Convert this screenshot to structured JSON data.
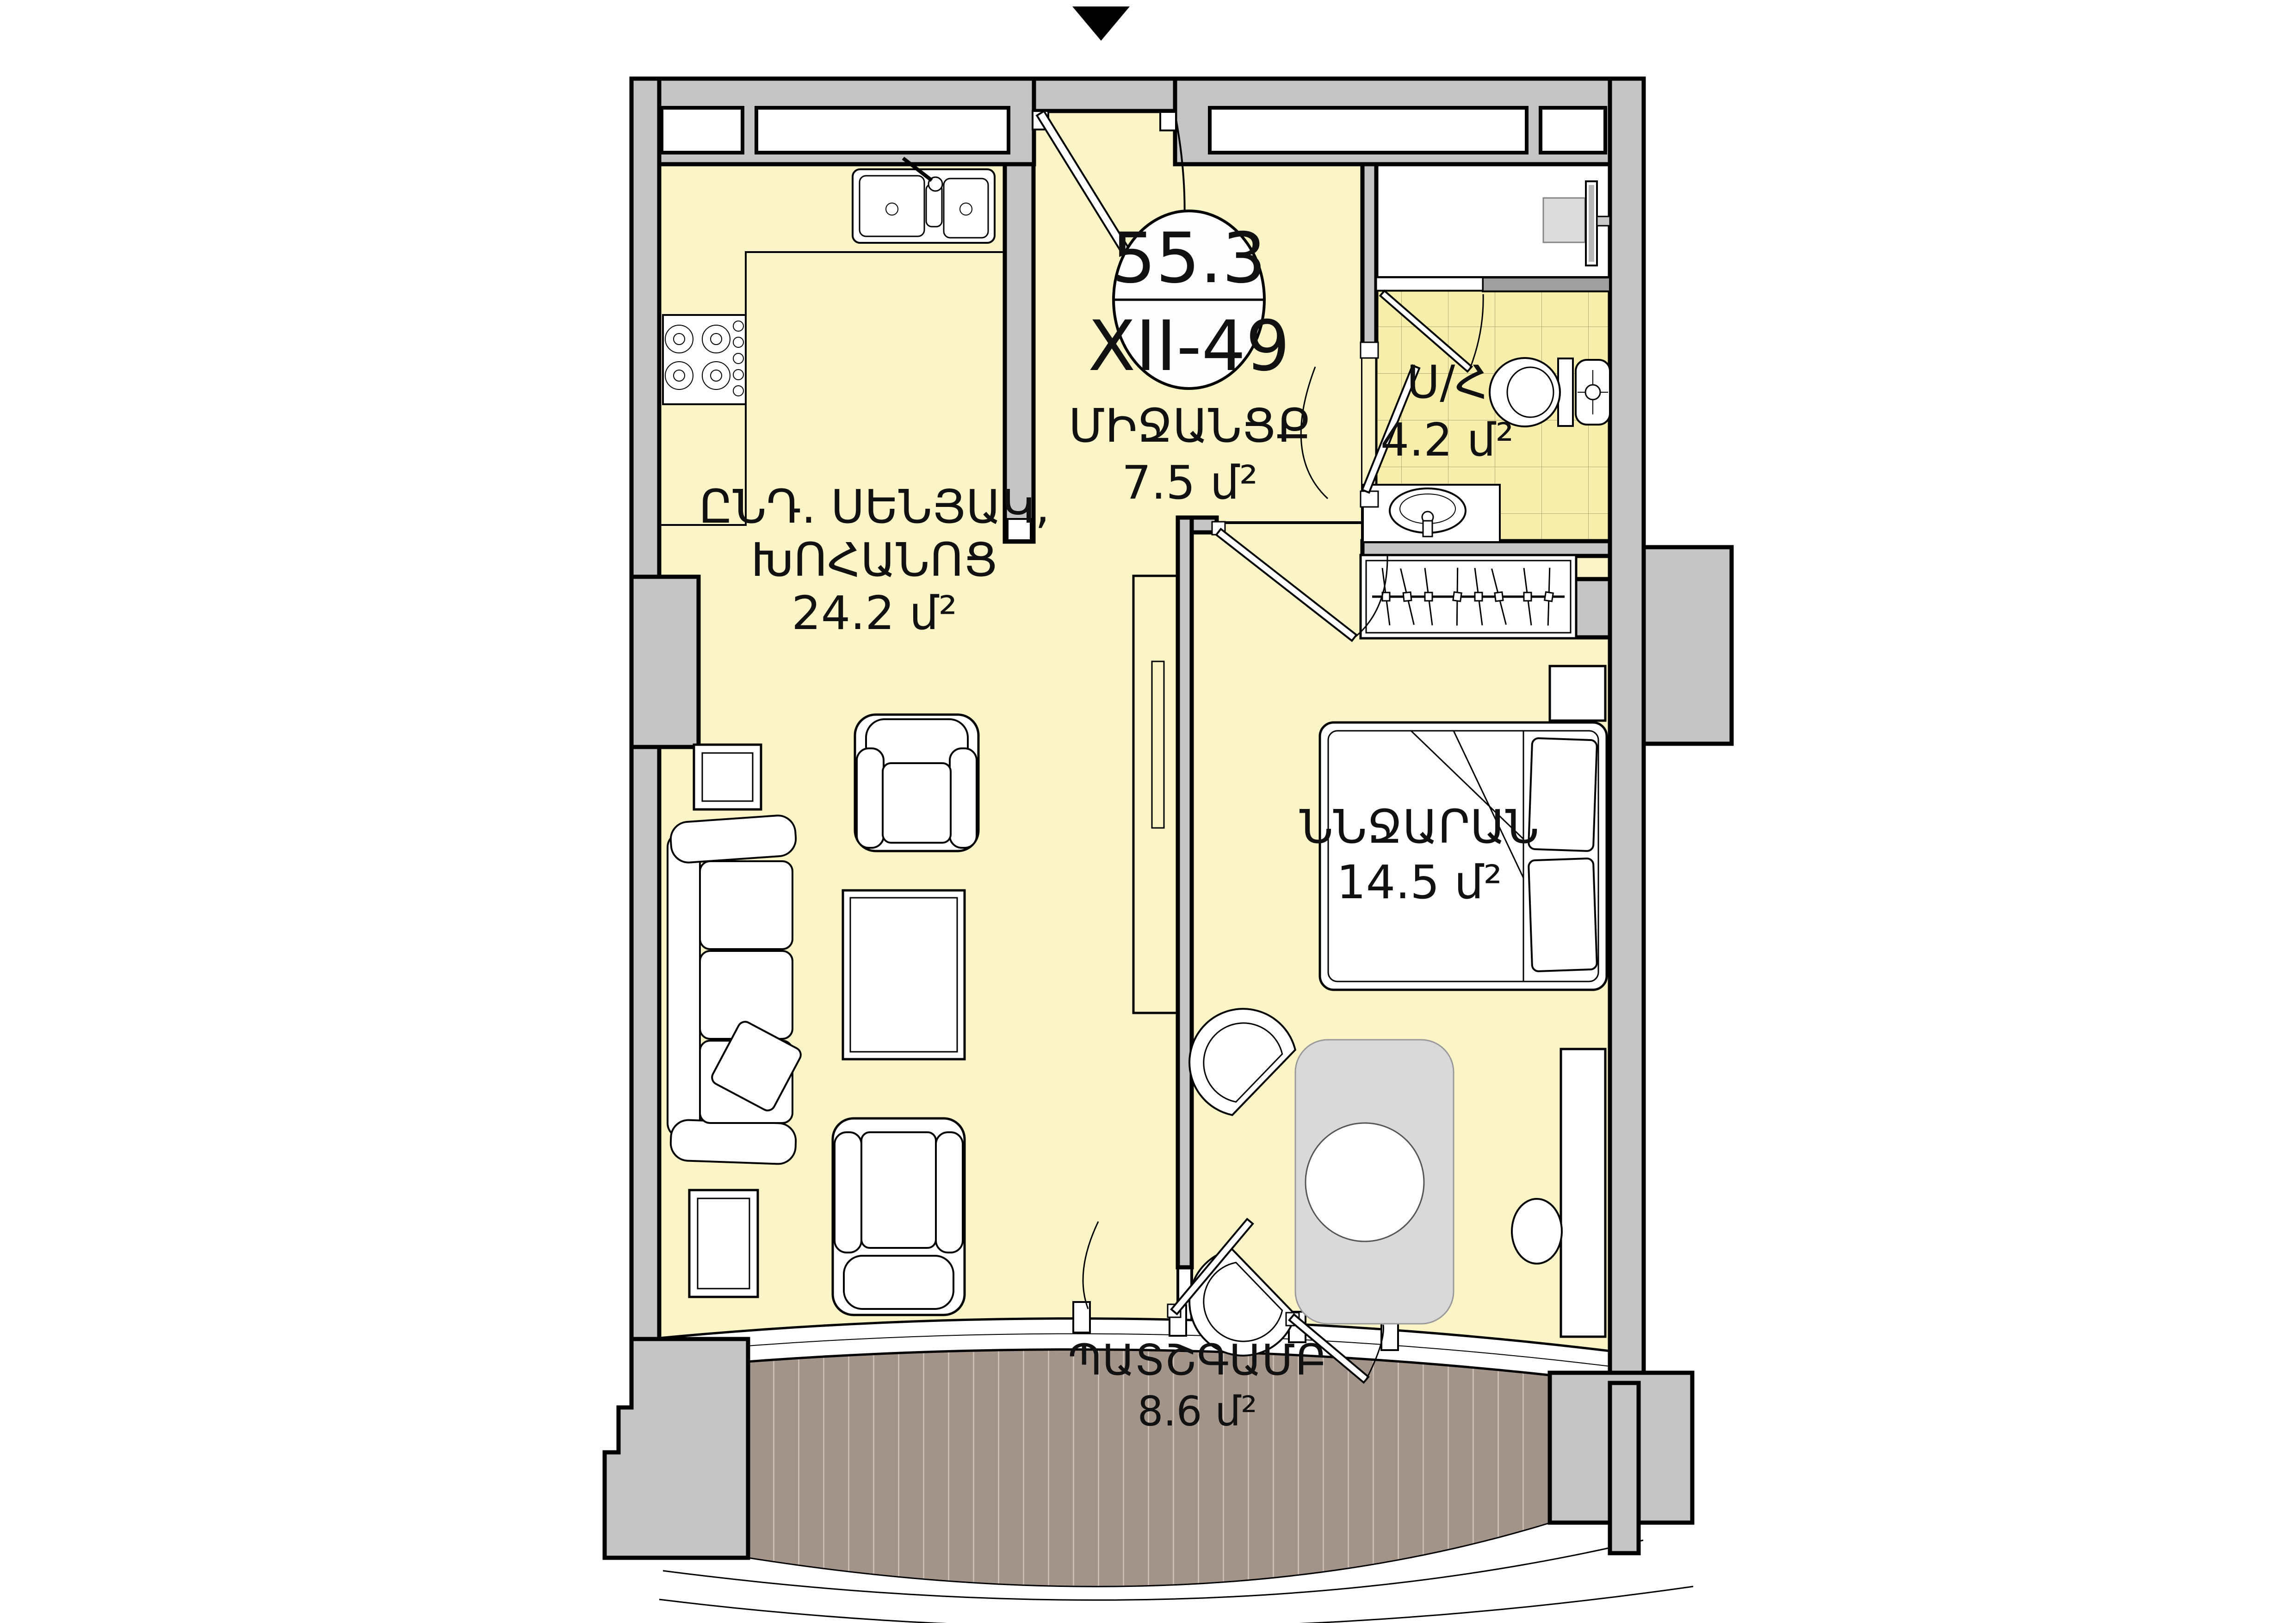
{
  "document": {
    "type": "apartment-floor-plan"
  },
  "icons": {
    "entrance-marker": "down-triangle"
  },
  "unit": {
    "total_area": "55.3",
    "number": "XII-49"
  },
  "rooms": {
    "hallway": {
      "name": "ՄԻՋԱՆՑՔ",
      "area": "7.5 մ²"
    },
    "living_kitchen": {
      "name_line1": "ԸՆԴ. ՍԵՆՅԱԿ,",
      "name_line2": "ԽՈՀԱՆՈՑ",
      "area": "24.2 մ²"
    },
    "bathroom": {
      "name": "Ս/Հ",
      "area": "4.2 մ²"
    },
    "bedroom": {
      "name": "ՆՆՋԱՐԱՆ",
      "area": "14.5 մ²"
    },
    "balcony": {
      "name": "ՊԱՏՇԳԱՄԲ",
      "area": "8.6 մ²"
    }
  },
  "colors": {
    "wall_gray": "#c5c5c5",
    "floor_yellow": "#fbf4c7",
    "bathroom_tile": "#f7eeab",
    "balcony_deck": "#a3948a",
    "table_gray": "#d9d9d9",
    "outline_black": "#000000"
  }
}
